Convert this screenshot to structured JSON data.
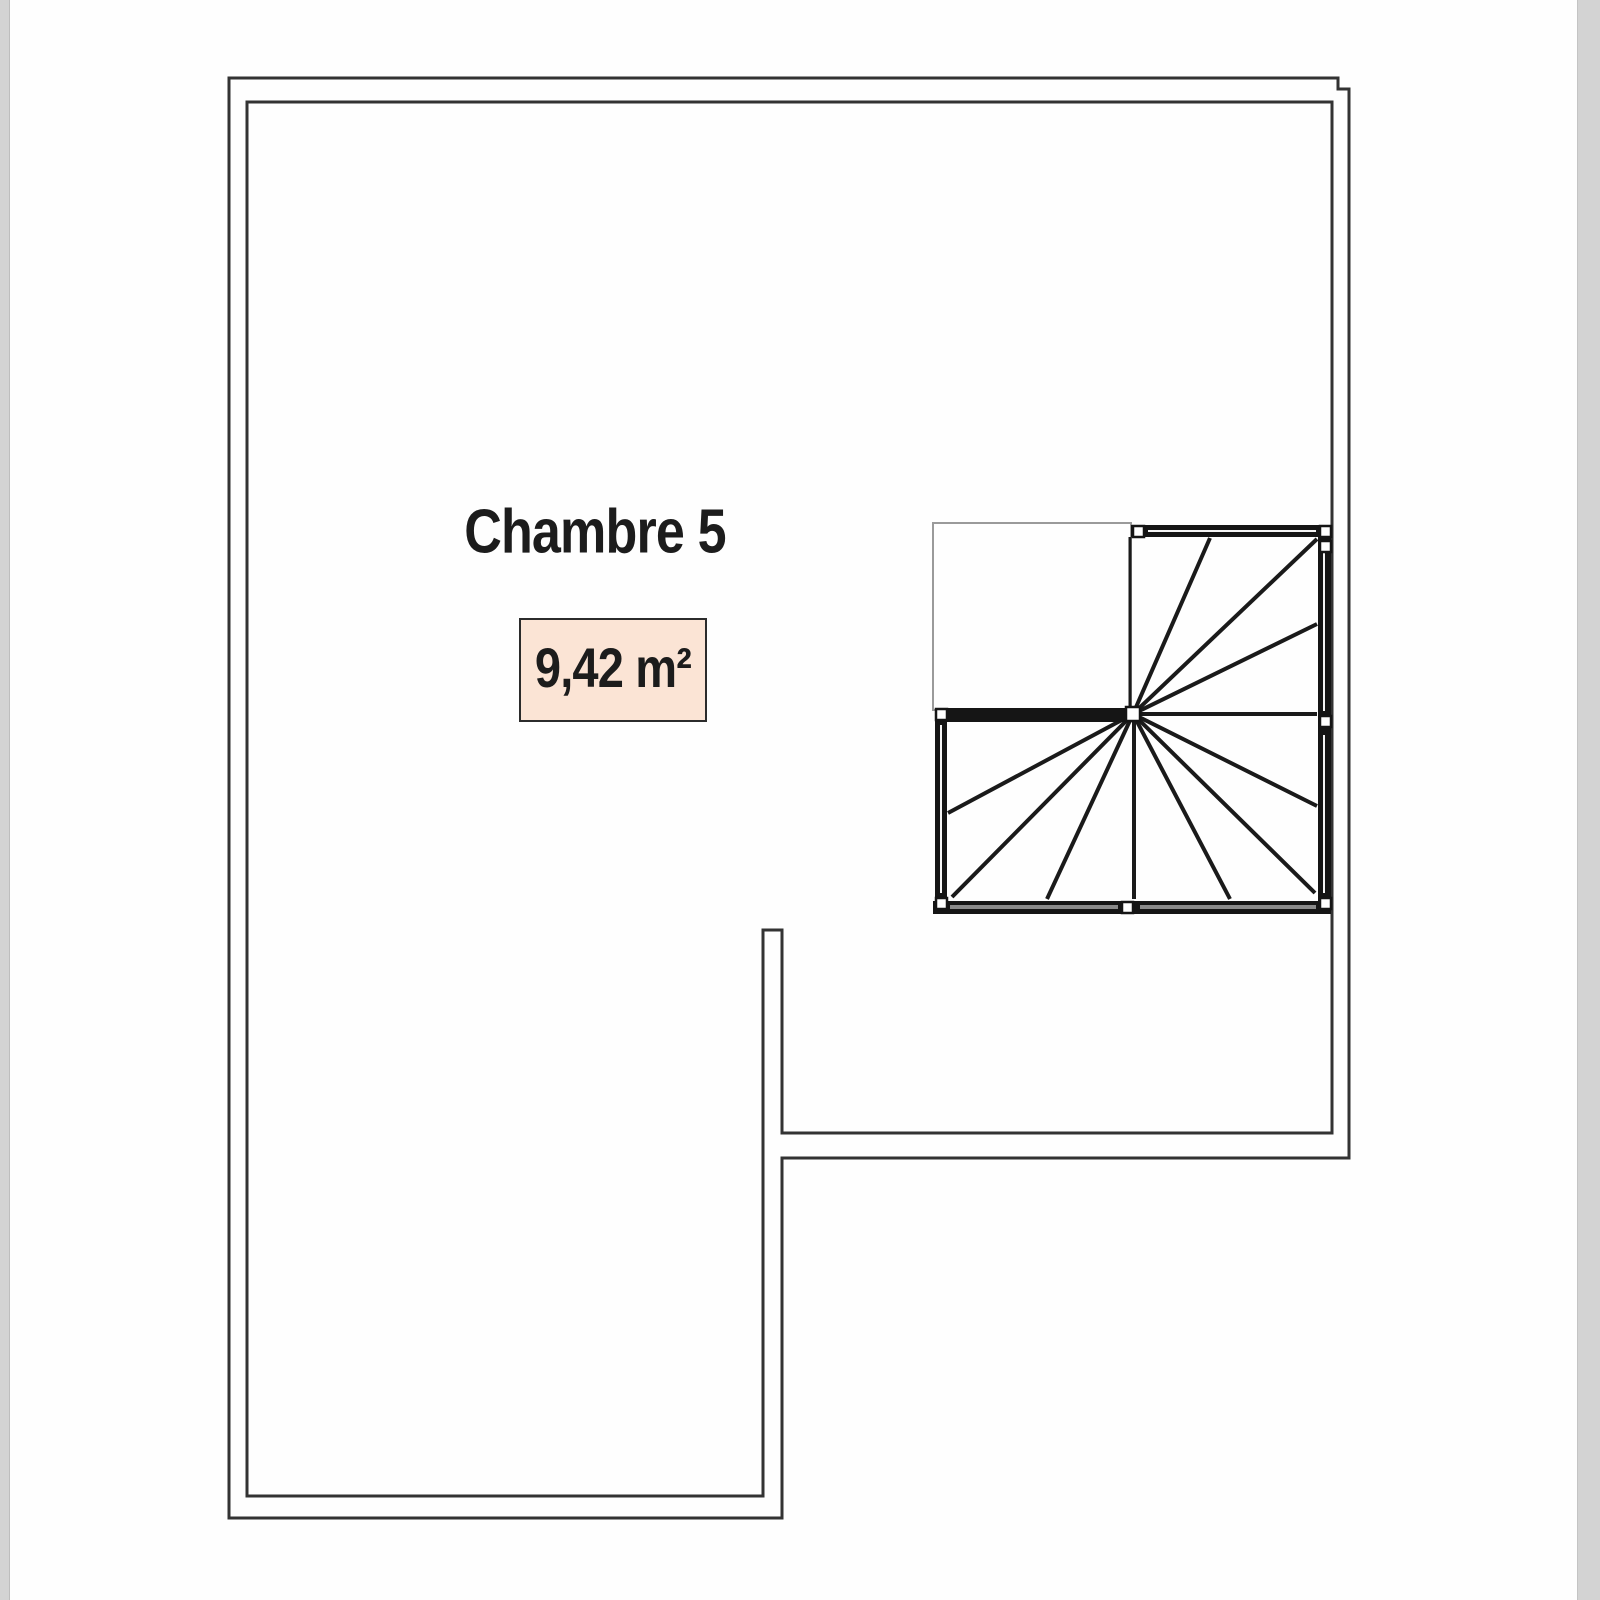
{
  "plan": {
    "room_label": "Chambre 5",
    "area_label": "9,42 m²",
    "colors": {
      "background": "#fefefe",
      "page_edge": "#d3d3d3",
      "wall_line": "#333333",
      "stair_wall": "#151515",
      "stair_tread": "#1a1a1a",
      "landing_outline": "#9a9a9a",
      "wall_cap_fill": "#ffffff",
      "bottom_wall_stripe": "#8a8a8a",
      "wall_inner_stripe": "#f5f5f5",
      "area_box_fill": "#fbe4d5",
      "area_box_border": "#2b2b2b",
      "text": "#1c1c1c"
    }
  }
}
